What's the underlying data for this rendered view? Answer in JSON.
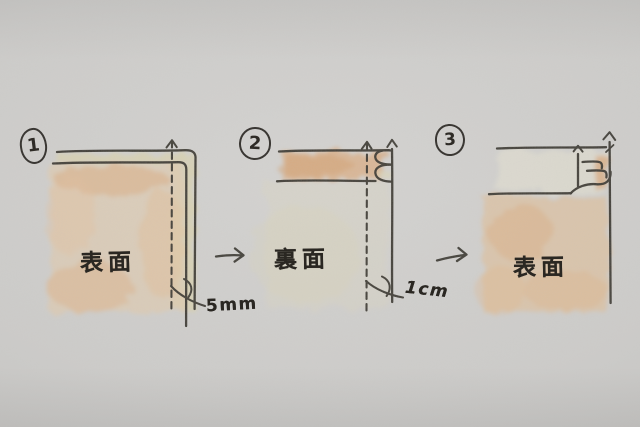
{
  "figure": {
    "type": "hand-drawn-sewing-diagram",
    "steps": [
      {
        "number": "1",
        "fabric_label": "表面",
        "measurement": "5mm"
      },
      {
        "number": "2",
        "fabric_label": "裏面",
        "measurement": "1cm"
      },
      {
        "number": "3",
        "fabric_label": "表面"
      }
    ],
    "transitions": [
      {
        "icon": "arrow-right"
      },
      {
        "icon": "arrow-right"
      }
    ],
    "colors": {
      "paper": "#cdccca",
      "ink": "#35322b",
      "fabric_front_wash": "#e2b285",
      "fabric_edge_cream": "#d9d2ae"
    }
  }
}
